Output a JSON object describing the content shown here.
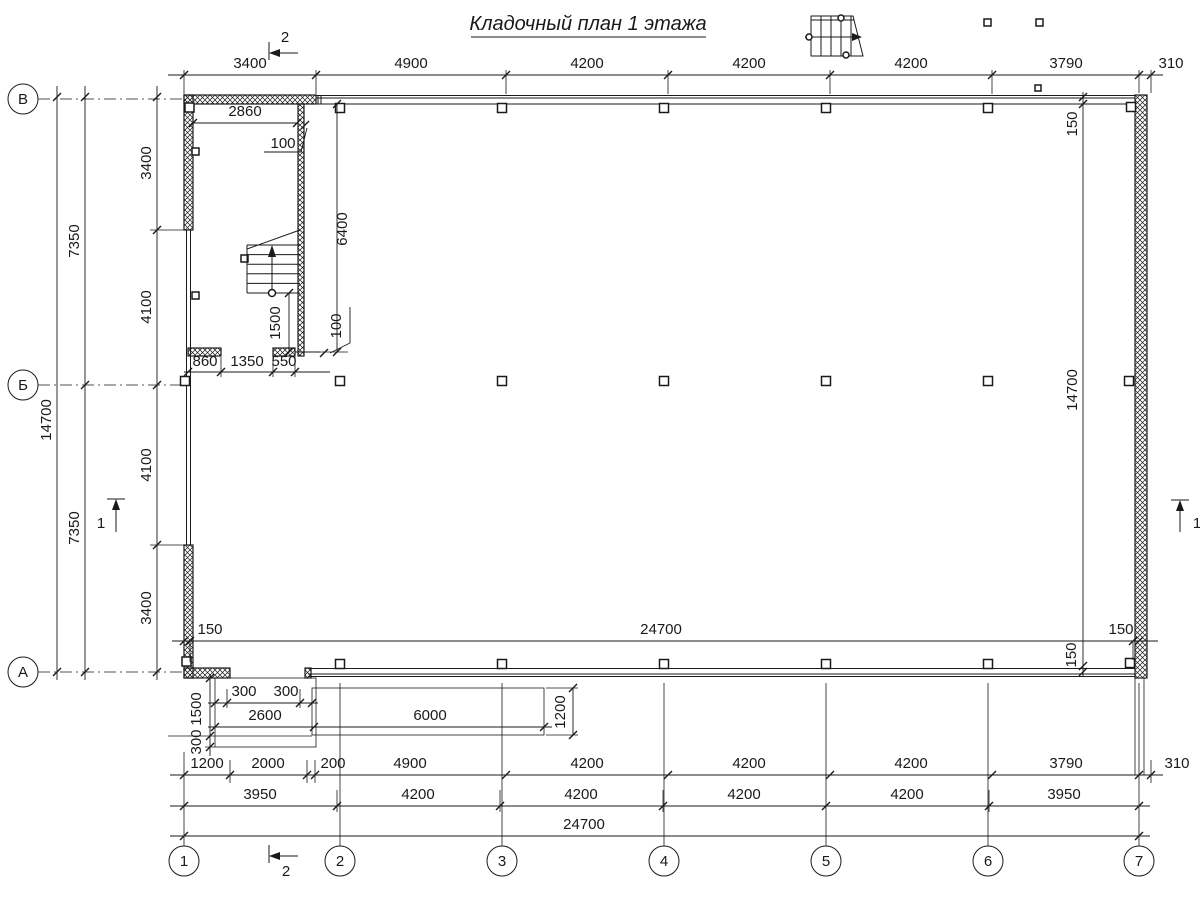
{
  "title": "Кладочный план 1 этажа",
  "colors": {
    "ink": "#1a1a1a",
    "background": "#ffffff"
  },
  "axes": {
    "rows": [
      "В",
      "Б",
      "А"
    ],
    "cols": [
      "1",
      "2",
      "3",
      "4",
      "5",
      "6",
      "7"
    ]
  },
  "sections": {
    "top": "2",
    "bottom": "2",
    "left": "1",
    "right": "1"
  },
  "dims": {
    "top": [
      "3400",
      "4900",
      "4200",
      "4200",
      "4200",
      "3790",
      "310"
    ],
    "left_inner": [
      "3400",
      "4100",
      "4100",
      "3400"
    ],
    "left_mid": [
      "7350",
      "7350"
    ],
    "left_outer": "14700",
    "right": [
      "150",
      "14700",
      "150"
    ],
    "width_inner": [
      "150",
      "24700",
      "150"
    ],
    "room_width": "2860",
    "room_wall_top": "100",
    "room_height": "6400",
    "stair_landing": "1500",
    "room_wall_bottom": "100",
    "door": [
      "860",
      "1350",
      "550"
    ],
    "porch_offsets": [
      "300",
      "300"
    ],
    "porch_w1": "2600",
    "porch_w2": "6000",
    "porch_depth": "1200",
    "porch_v": [
      "1500",
      "300"
    ],
    "chain1": [
      "1200",
      "2000",
      "200",
      "4900",
      "4200",
      "4200",
      "4200",
      "3790",
      "310"
    ],
    "chain2": [
      "3950",
      "4200",
      "4200",
      "4200",
      "4200",
      "3950"
    ],
    "chain3": "24700"
  }
}
